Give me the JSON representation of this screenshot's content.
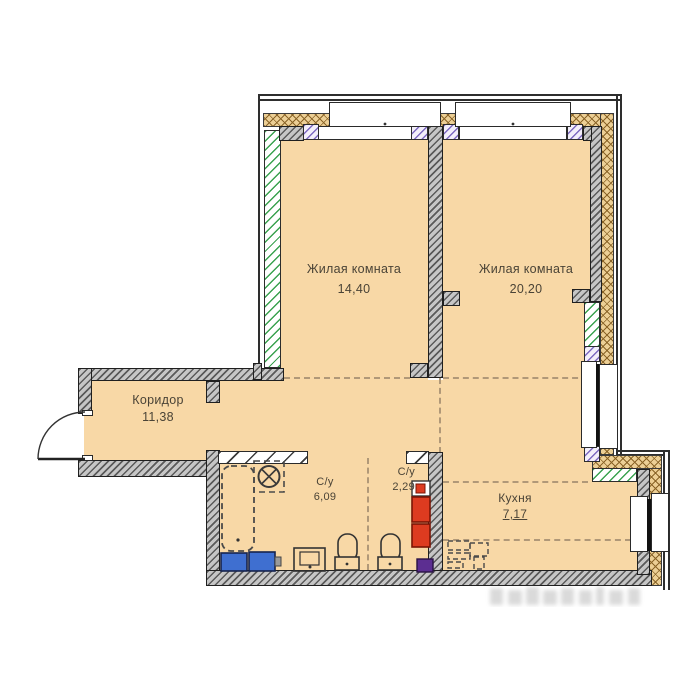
{
  "rooms": [
    {
      "name": "Жилая комната",
      "area": "14,40"
    },
    {
      "name": "Жилая комната",
      "area": "20,20"
    },
    {
      "name": "Коридор",
      "area": "11,38"
    },
    {
      "name": "С/у",
      "area": "6,09"
    },
    {
      "name": "С/у",
      "area": "2,29"
    },
    {
      "name": "Кухня",
      "area": "7,17"
    }
  ],
  "colors": {
    "floor": "#f8d8a6",
    "wall_light": "#c6c6c6",
    "wall_dark": "#5a5a5a",
    "outline": "#1f1f1f",
    "insulation_bg": "#eccf95",
    "insulation_line": "#8a6428",
    "glass_green": "#3aa24f",
    "jamb_purple": "#7d6ac1",
    "dash": "#b09878",
    "fixture_blue": "#3f6fd0",
    "fixture_red": "#dd3b20",
    "fixture_purple": "#5c2e91",
    "label": "#4a4336"
  }
}
